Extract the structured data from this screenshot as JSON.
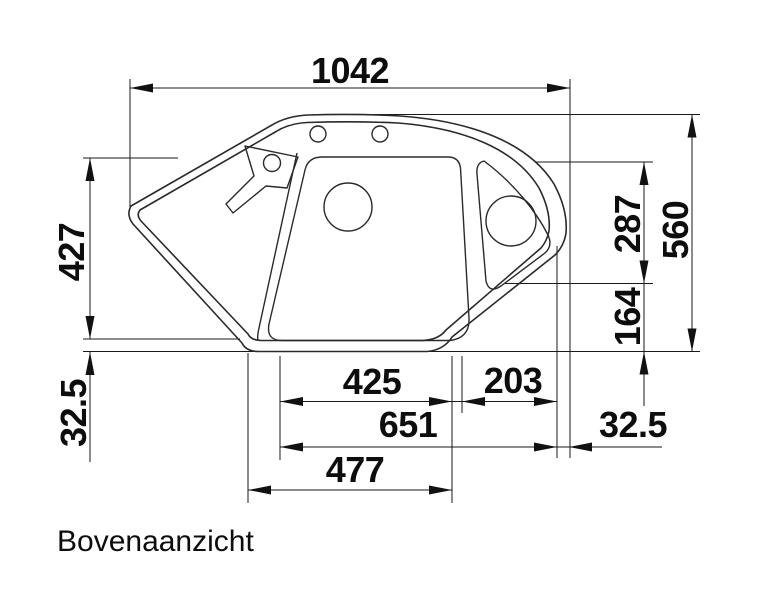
{
  "caption": "Bovenaanzicht",
  "drawing": {
    "kind": "sink-top-view-technical-drawing",
    "line_color": "#1a1a1a",
    "background": "#ffffff",
    "labels": {
      "total_width": "1042",
      "left_depth": "427",
      "rim_bottom_left": "32.5",
      "corner_upper": "287",
      "total_depth": "560",
      "corner_lower": "164",
      "main_basin_width": "425",
      "corner_basin_width": "203",
      "inner_width": "651",
      "rim_right": "32.5",
      "bottom_width": "477"
    }
  }
}
